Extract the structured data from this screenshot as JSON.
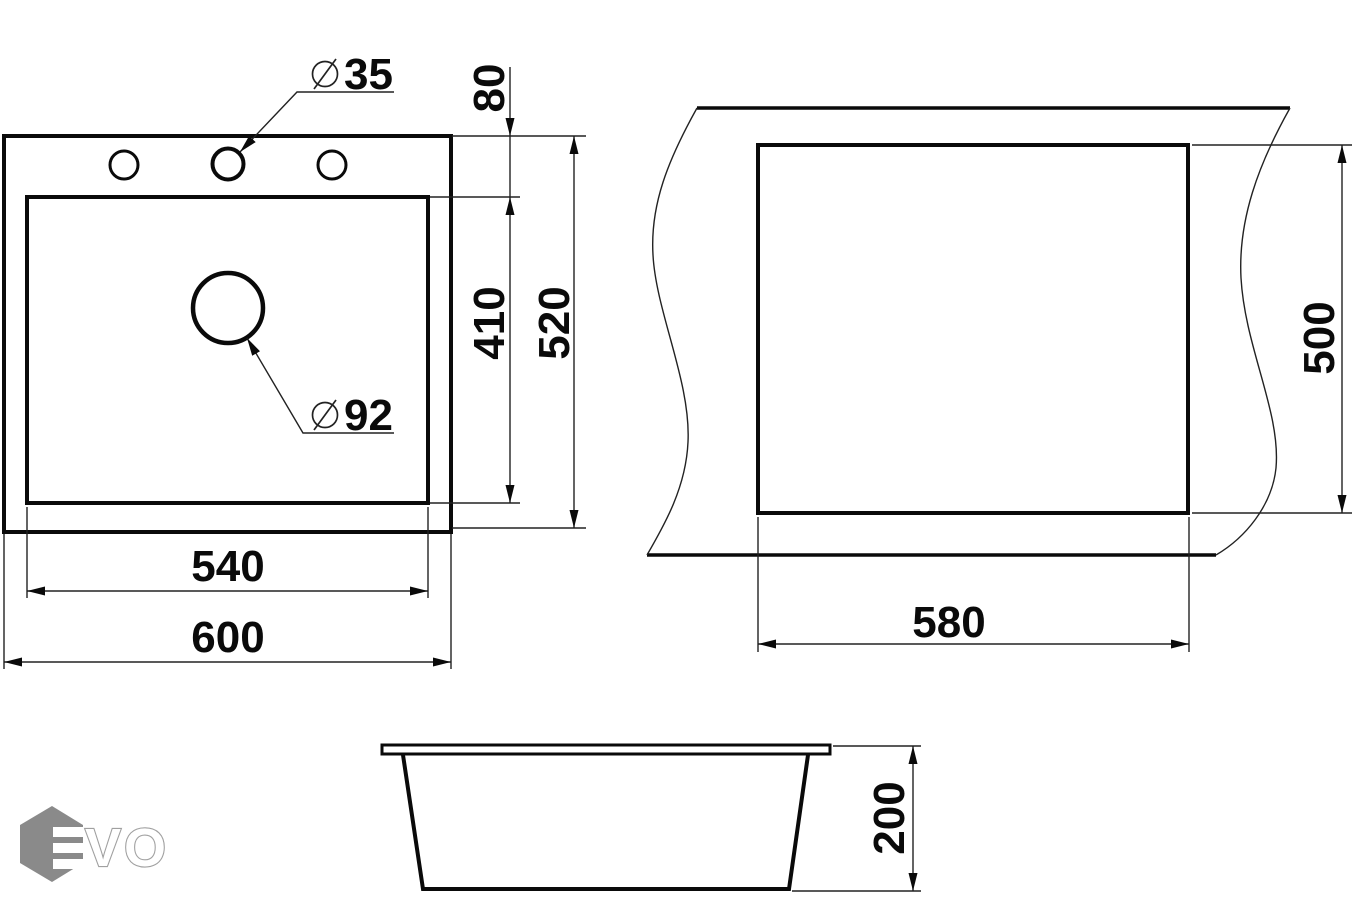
{
  "drawing_title": "sink-dimension-drawing",
  "colors": {
    "line": "#0a0a0a",
    "background": "#ffffff",
    "section_dim_text": "#555555",
    "logo_hexagon": "#8a8a8a",
    "logo_outline": "#a0a0a0"
  },
  "top_view": {
    "overall_width": "600",
    "bowl_width": "540",
    "overall_depth": "520",
    "bowl_depth": "410",
    "faucet_offset": "80",
    "faucet_hole": {
      "symbol": "⌀",
      "value": "35"
    },
    "drain_hole": {
      "symbol": "⌀",
      "value": "92"
    }
  },
  "cutout_view": {
    "width": "580",
    "depth": "500"
  },
  "section_view": {
    "height": "200"
  },
  "logo": {
    "vo": "VO",
    "hexagon_color": "#8a8a8a",
    "outline_color": "#a0a0a0",
    "dim_gray": "#555555"
  }
}
